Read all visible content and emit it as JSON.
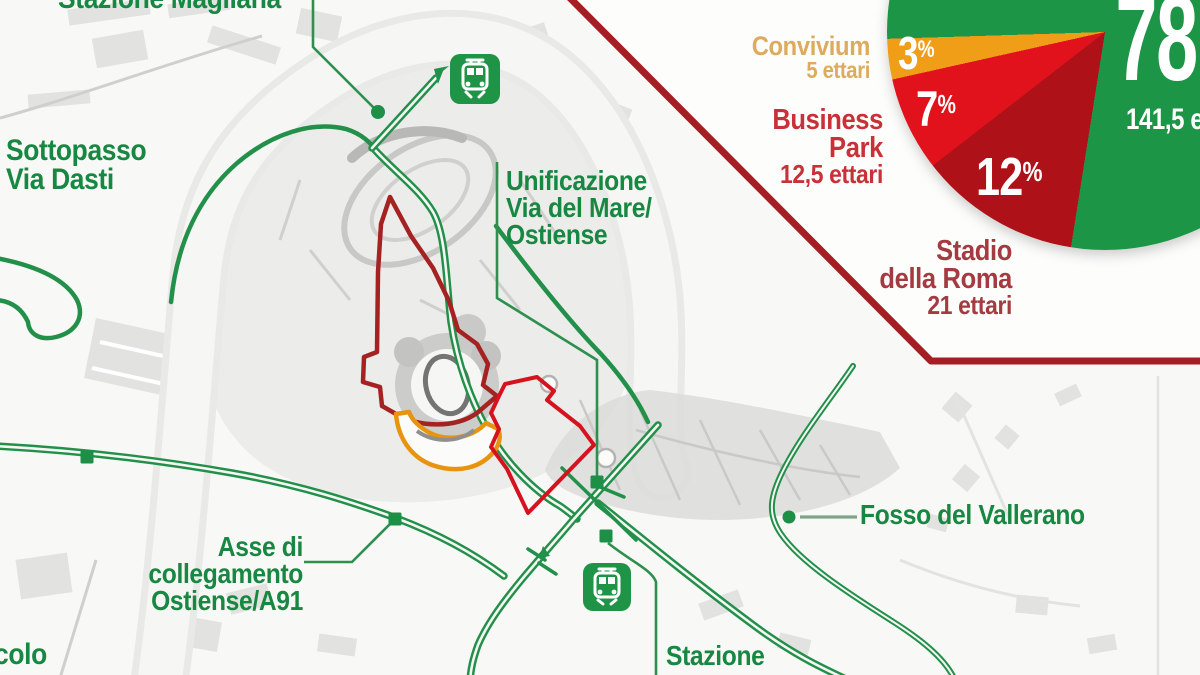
{
  "map": {
    "labels": {
      "stazione_magliana": "Stazione Magliana",
      "sottopasso": [
        "Sottopasso",
        "Via Dasti"
      ],
      "unificazione": [
        "Unificazione",
        "Via del Mare/",
        "Ostiense"
      ],
      "asse": [
        "Asse di",
        "collegamento",
        "Ostiense/A91"
      ],
      "fosso": "Fosso del Vallerano",
      "stazione_bottom": [
        "Stazione",
        "Tor di Valle"
      ],
      "fragment_bottom_left": "colo"
    },
    "colors": {
      "route_green": "#23904a",
      "label_green": "#178742",
      "stadio_outline_red": "#a42322",
      "business_outline_red": "#d6121f",
      "convivium_outline_orange": "#e8940e"
    }
  },
  "panel": {
    "border_color": "#a51e24",
    "slice_labels": {
      "convivium": {
        "name": "Convivium",
        "area": "5 ettari",
        "pct": "3",
        "sym": "%"
      },
      "business_park": {
        "name1": "Business",
        "name2": "Park",
        "area": "12,5 ettari",
        "pct": "7",
        "sym": "%"
      },
      "stadio": {
        "name1": "Stadio",
        "name2": "della Roma",
        "area": "21 ettari",
        "pct": "12",
        "sym": "%"
      },
      "green": {
        "pct": "78",
        "area": "141,5 ettari"
      }
    }
  },
  "chart_data": {
    "type": "pie",
    "title": "",
    "units": "ettari",
    "start_angle_deg": 189,
    "legend_position": "left",
    "slices": [
      {
        "label": "Stadio della Roma",
        "value": 12,
        "area_label": "21 ettari",
        "color": "#ae1117"
      },
      {
        "label": "Business Park",
        "value": 7,
        "area_label": "12,5 ettari",
        "color": "#e1121c"
      },
      {
        "label": "Convivium",
        "value": 3,
        "area_label": "5 ettari",
        "color": "#f09d18"
      },
      {
        "label": "",
        "value": 78,
        "area_label": "141,5 ettari",
        "color": "#1d9546"
      }
    ]
  }
}
